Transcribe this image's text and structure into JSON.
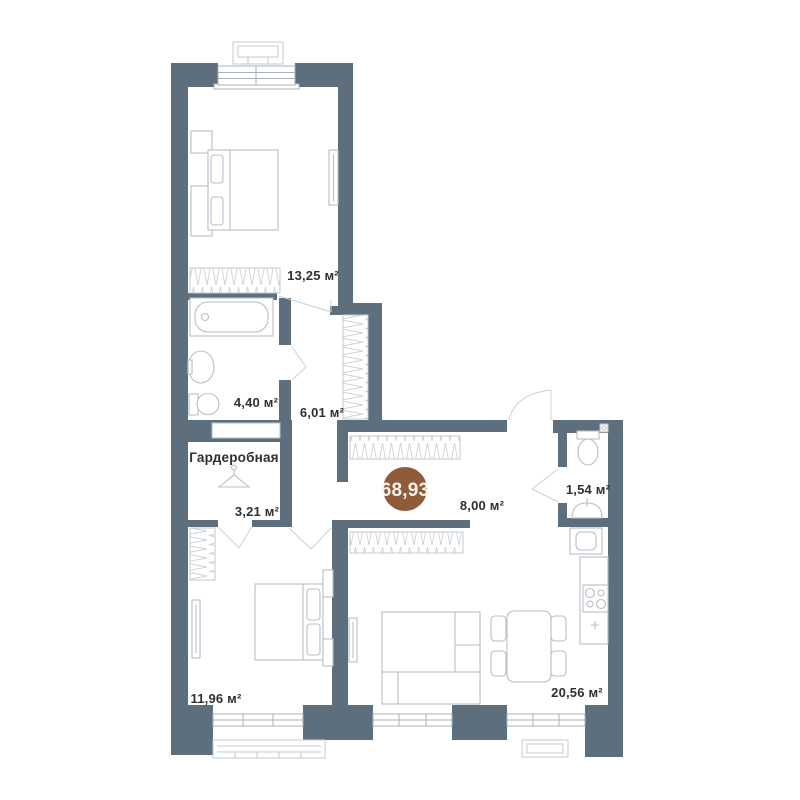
{
  "plan": {
    "rooms": {
      "bedroom_top": {
        "area": "13,25 м²"
      },
      "bathroom": {
        "area": "4,40 м²"
      },
      "hallway": {
        "area": "6,01 м²"
      },
      "wardrobe": {
        "name": "Гардеробная",
        "area": "3,21 м²"
      },
      "entry_hall": {
        "area": "8,00 м²"
      },
      "wc": {
        "area": "1,54 м²"
      },
      "bedroom_bottom": {
        "area": "11,96 м²"
      },
      "living_kitchen": {
        "area": "20,56 м²"
      }
    },
    "total_area_badge": {
      "value": "68,93",
      "color": "#8f5b3b",
      "text_color": "#fbf2ea"
    },
    "colors": {
      "wall": "#5d6f7c",
      "furniture_stroke": "#b7bfc6",
      "hatch": "#ccd3d8",
      "door_stroke": "#ccd1d5",
      "window_stroke": "#a9b3ba",
      "text": "#2e3033",
      "background": "#ffffff"
    }
  }
}
